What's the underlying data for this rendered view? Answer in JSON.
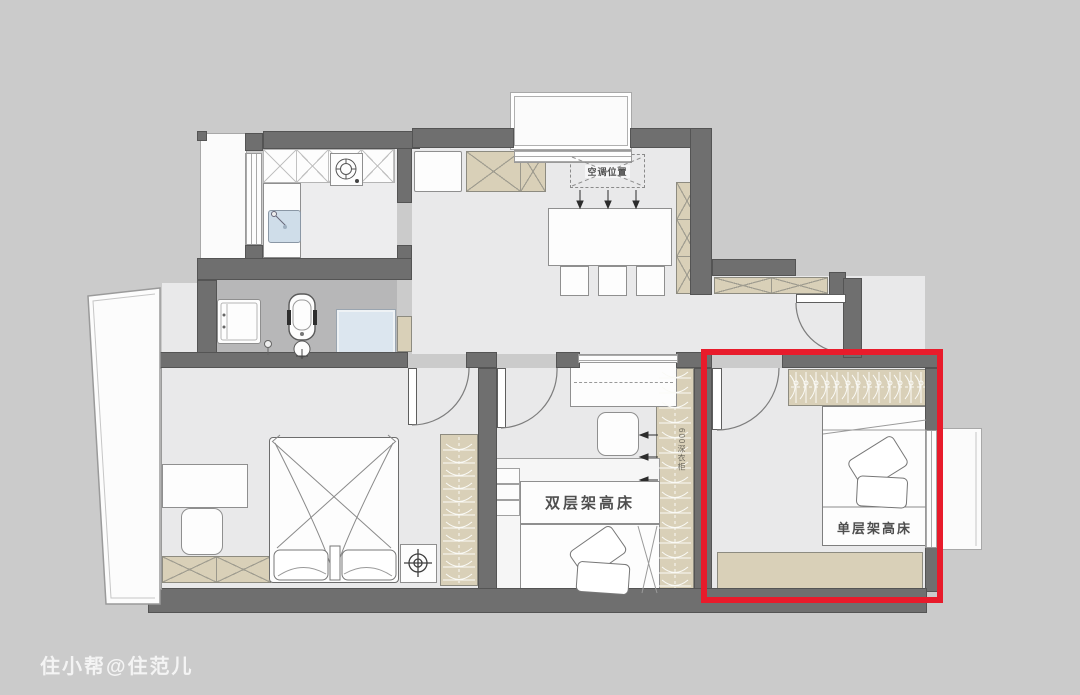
{
  "watermark": {
    "text": "住小帮@住范儿"
  },
  "plan": {
    "annotations": {
      "ac_position": "空调位置",
      "double_loft_bed": "双层架高床",
      "single_loft_bed": "单层架高床",
      "wardrobe_note": "600深衣柜"
    },
    "highlight": {
      "color": "#E81B2B"
    },
    "colors": {
      "background": "#CBCBCB",
      "wall": "#6F6F6F",
      "floor": "#E9E9EA",
      "bathroom_floor": "#B7B7B8",
      "cabinet_tan": "#D9D0B8",
      "shower_glass": "#DCE6EF",
      "sink_blue": "#CFDDE9",
      "highlight_red": "#E81B2B"
    }
  }
}
